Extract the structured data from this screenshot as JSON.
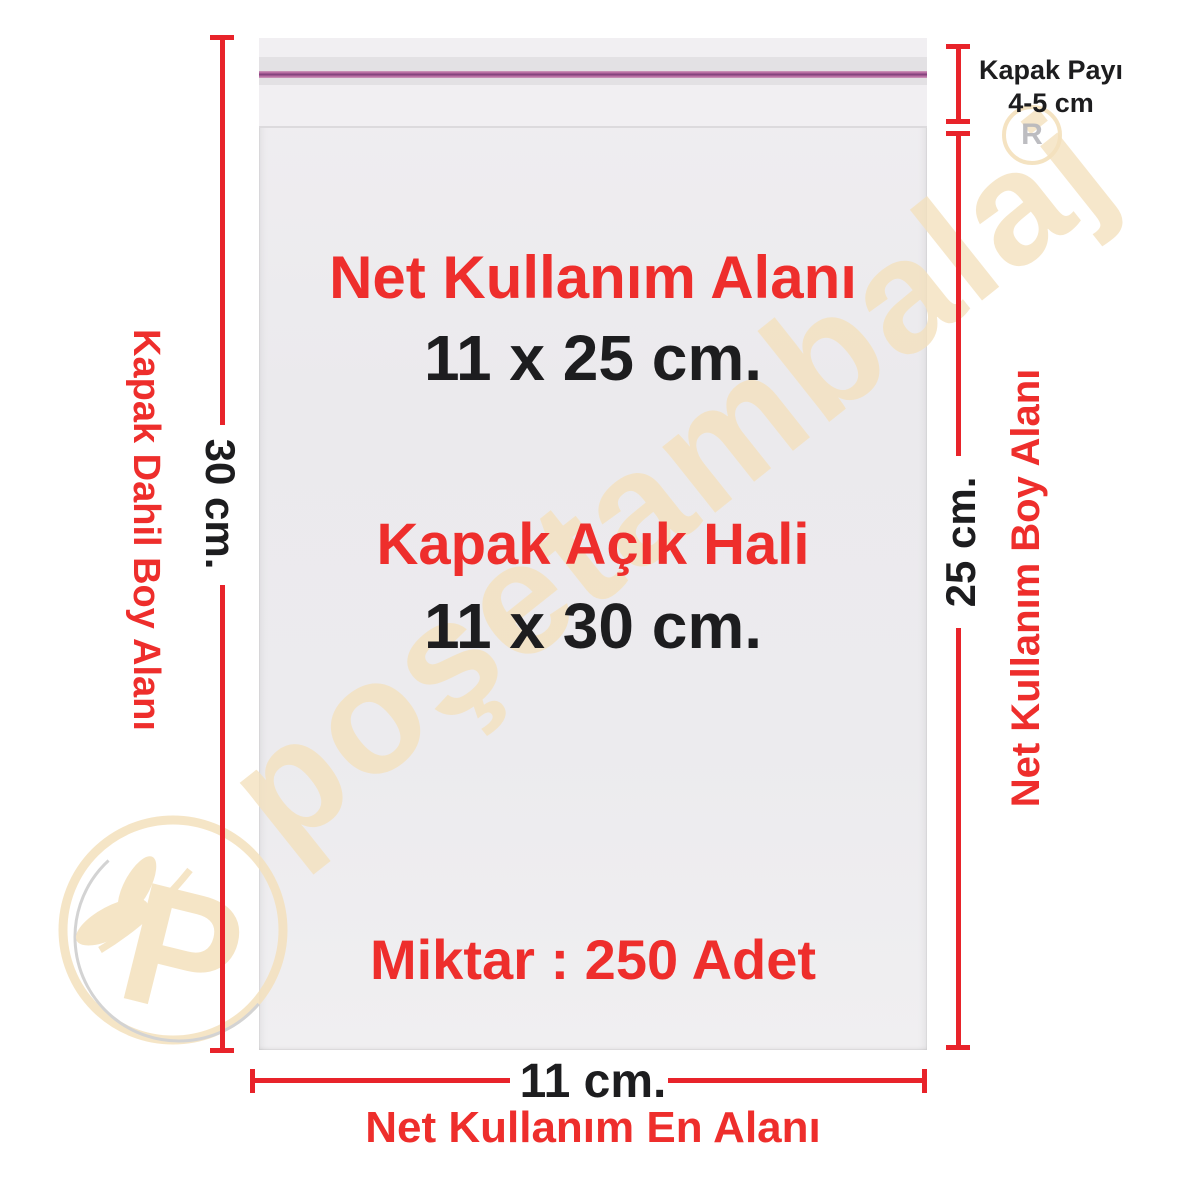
{
  "product_annotation": {
    "center": {
      "area_title": "Net Kullanım Alanı",
      "area_size": "11 x 25 cm.",
      "open_title": "Kapak Açık Hali",
      "open_size": "11 x 30 cm.",
      "quantity": "Miktar : 250 Adet"
    },
    "left": {
      "side_label": "Kapak Dahil Boy Alanı",
      "dimension": "30 cm."
    },
    "right": {
      "side_label": "Net Kullanım Boy Alanı",
      "dimension": "25 cm.",
      "flap_line1": "Kapak Payı",
      "flap_line2": "4-5 cm"
    },
    "bottom": {
      "dimension": "11 cm.",
      "width_label": "Net Kullanım En Alanı"
    }
  },
  "watermark": {
    "brand": "poşetambalaj",
    "registered_letter": "R",
    "logo_letter": "P"
  },
  "colors": {
    "red_text": "#ee2e2c",
    "red_line": "#e8232a",
    "black_text": "#1d1d1f",
    "watermark_beige": "#f4e1bd",
    "logo_gray": "#cccccc",
    "r_gray": "#b8b8bc",
    "bag_base": "#edecee",
    "bag_flap": "#f1eff2",
    "bag_band": "#e3e1e4",
    "pink_outer": "#cf9cbd",
    "pink_mid": "#b2649c",
    "pink_core": "#7b3f78",
    "fold": "#dcdadd"
  }
}
